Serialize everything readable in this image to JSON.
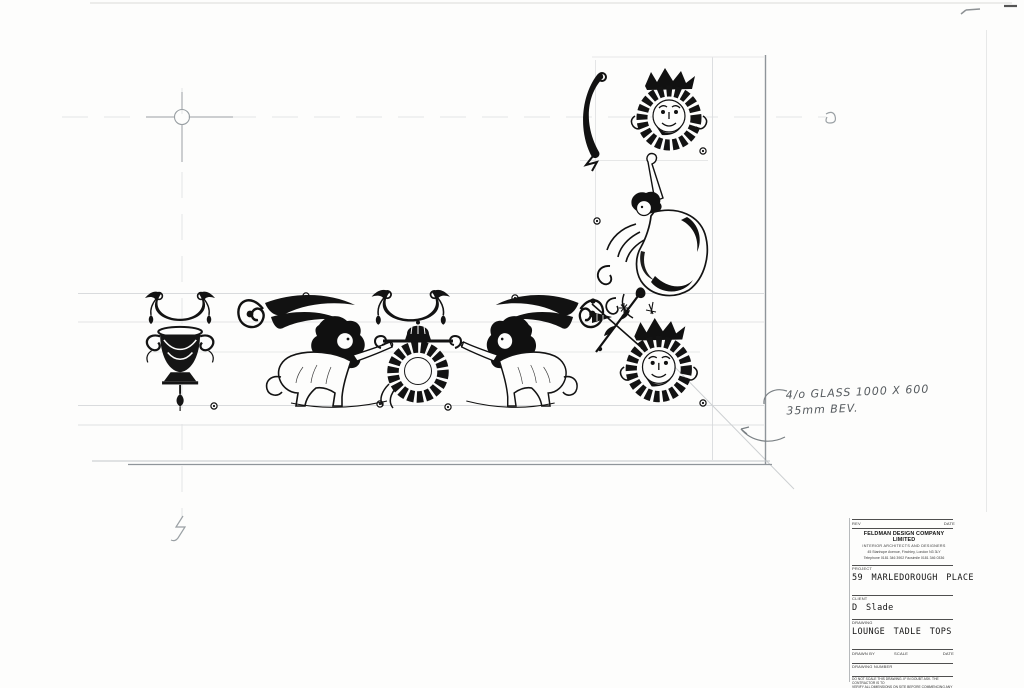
{
  "sheet": {
    "note": {
      "line1": "4/o GLASS 1000 X 600",
      "line2": "35mm BEV."
    },
    "ornaments": [
      "swag-drapery-left",
      "ornate-urn",
      "winged-sphinx-facing-right",
      "swag-drapery-centre",
      "laurel-wreath-crown-medallion",
      "winged-sphinx-facing-left",
      "crossed-torch-floral-spray",
      "grotesque-mask-medallion-corner",
      "drapery-scroll-top",
      "grotesque-mask-medallion-top",
      "cherub-with-scrollwork"
    ],
    "marks": [
      "registration-circle-crosshair",
      "centreline-break-squiggle-right",
      "centreline-break-squiggle-bottom",
      "screw-position-dots",
      "mitre-diagonal"
    ],
    "colors": {
      "ink": "#111111",
      "guide_line": "#d9dbdd",
      "edge_line": "#8f959a",
      "note_ink": "#565b5f",
      "paper": "#fdfdfc"
    }
  },
  "title_block": {
    "rev_label": "REV",
    "date_label": "DATE",
    "company": "FELDMAN DESIGN COMPANY LIMITED",
    "company_sub": "INTERIOR ARCHITECTS AND DESIGNERS",
    "address": "45 Stanhope Avenue, Finchley, London N3 3LY",
    "phone": "Telephone 0181 346 3902  Facsimile 0181 346 0336",
    "project_label": "PROJECT",
    "project": "59 MARLEDOROUGH PLACE",
    "client_label": "CLIENT",
    "client": "D Slade",
    "drawing_label": "DRAWING",
    "drawing": "LOUNGE TADLE TOPS",
    "drawn_by_label": "DRAWN BY",
    "scale_label": "SCALE",
    "date2_label": "DATE",
    "drawing_number_label": "DRAWING NUMBER",
    "disclaimer_1": "DO NOT SCALE THIS DRAWING. IF IN DOUBT ASK. THE CONTRACTOR IS TO",
    "disclaimer_2": "VERIFY ALL DIMENSIONS ON SITE BEFORE COMMENCING ANY WORK. COPYRIGHT",
    "disclaimer_3": "OF THIS DRAWING IS RESERVED."
  }
}
